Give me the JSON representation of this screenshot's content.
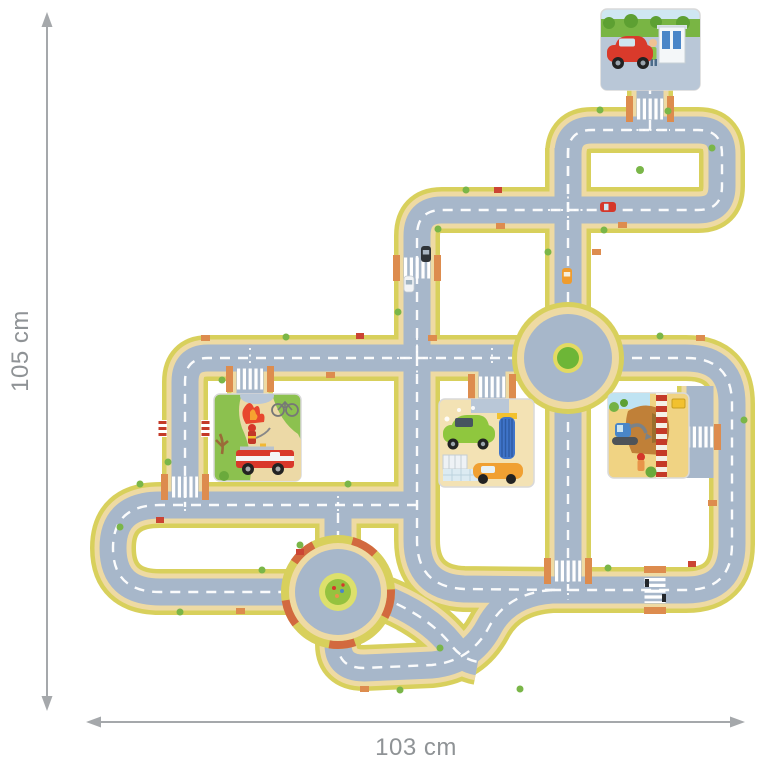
{
  "image_type": "product-dimension-illustration",
  "dimensions": {
    "height_label": "105 cm",
    "width_label": "103 cm"
  },
  "playmat": {
    "description": "Giant road-traffic puzzle playmat seen from above: interlocking street pieces with lanes, zebra crossings, two roundabouts and four picture scene tiles",
    "tiles": [
      {
        "name": "gas-station-tile",
        "description": "Red car refuelling at a petrol station"
      },
      {
        "name": "fire-rescue-tile",
        "description": "Fire engine and firefighter extinguishing a fire"
      },
      {
        "name": "car-wash-tile",
        "description": "Green car driving through a car wash, orange car waiting"
      },
      {
        "name": "construction-site-tile",
        "description": "Blue excavator on a construction site behind a red-white barrier"
      }
    ],
    "roundabouts": [
      {
        "name": "upper-roundabout",
        "center": "green island"
      },
      {
        "name": "lower-roundabout",
        "center": "flower meadow island"
      }
    ],
    "colors": {
      "road": "#a7b7ca",
      "sidewalk": "#eedaa3",
      "edge": "#d8d05c",
      "grass": "#7ab648",
      "brick": "#d2693f",
      "lane_marking": "#ffffff",
      "dimension": "#a5a8ab"
    }
  },
  "icons": {
    "vertical_dimension_arrow": "double-headed-arrow",
    "horizontal_dimension_arrow": "double-headed-arrow"
  }
}
